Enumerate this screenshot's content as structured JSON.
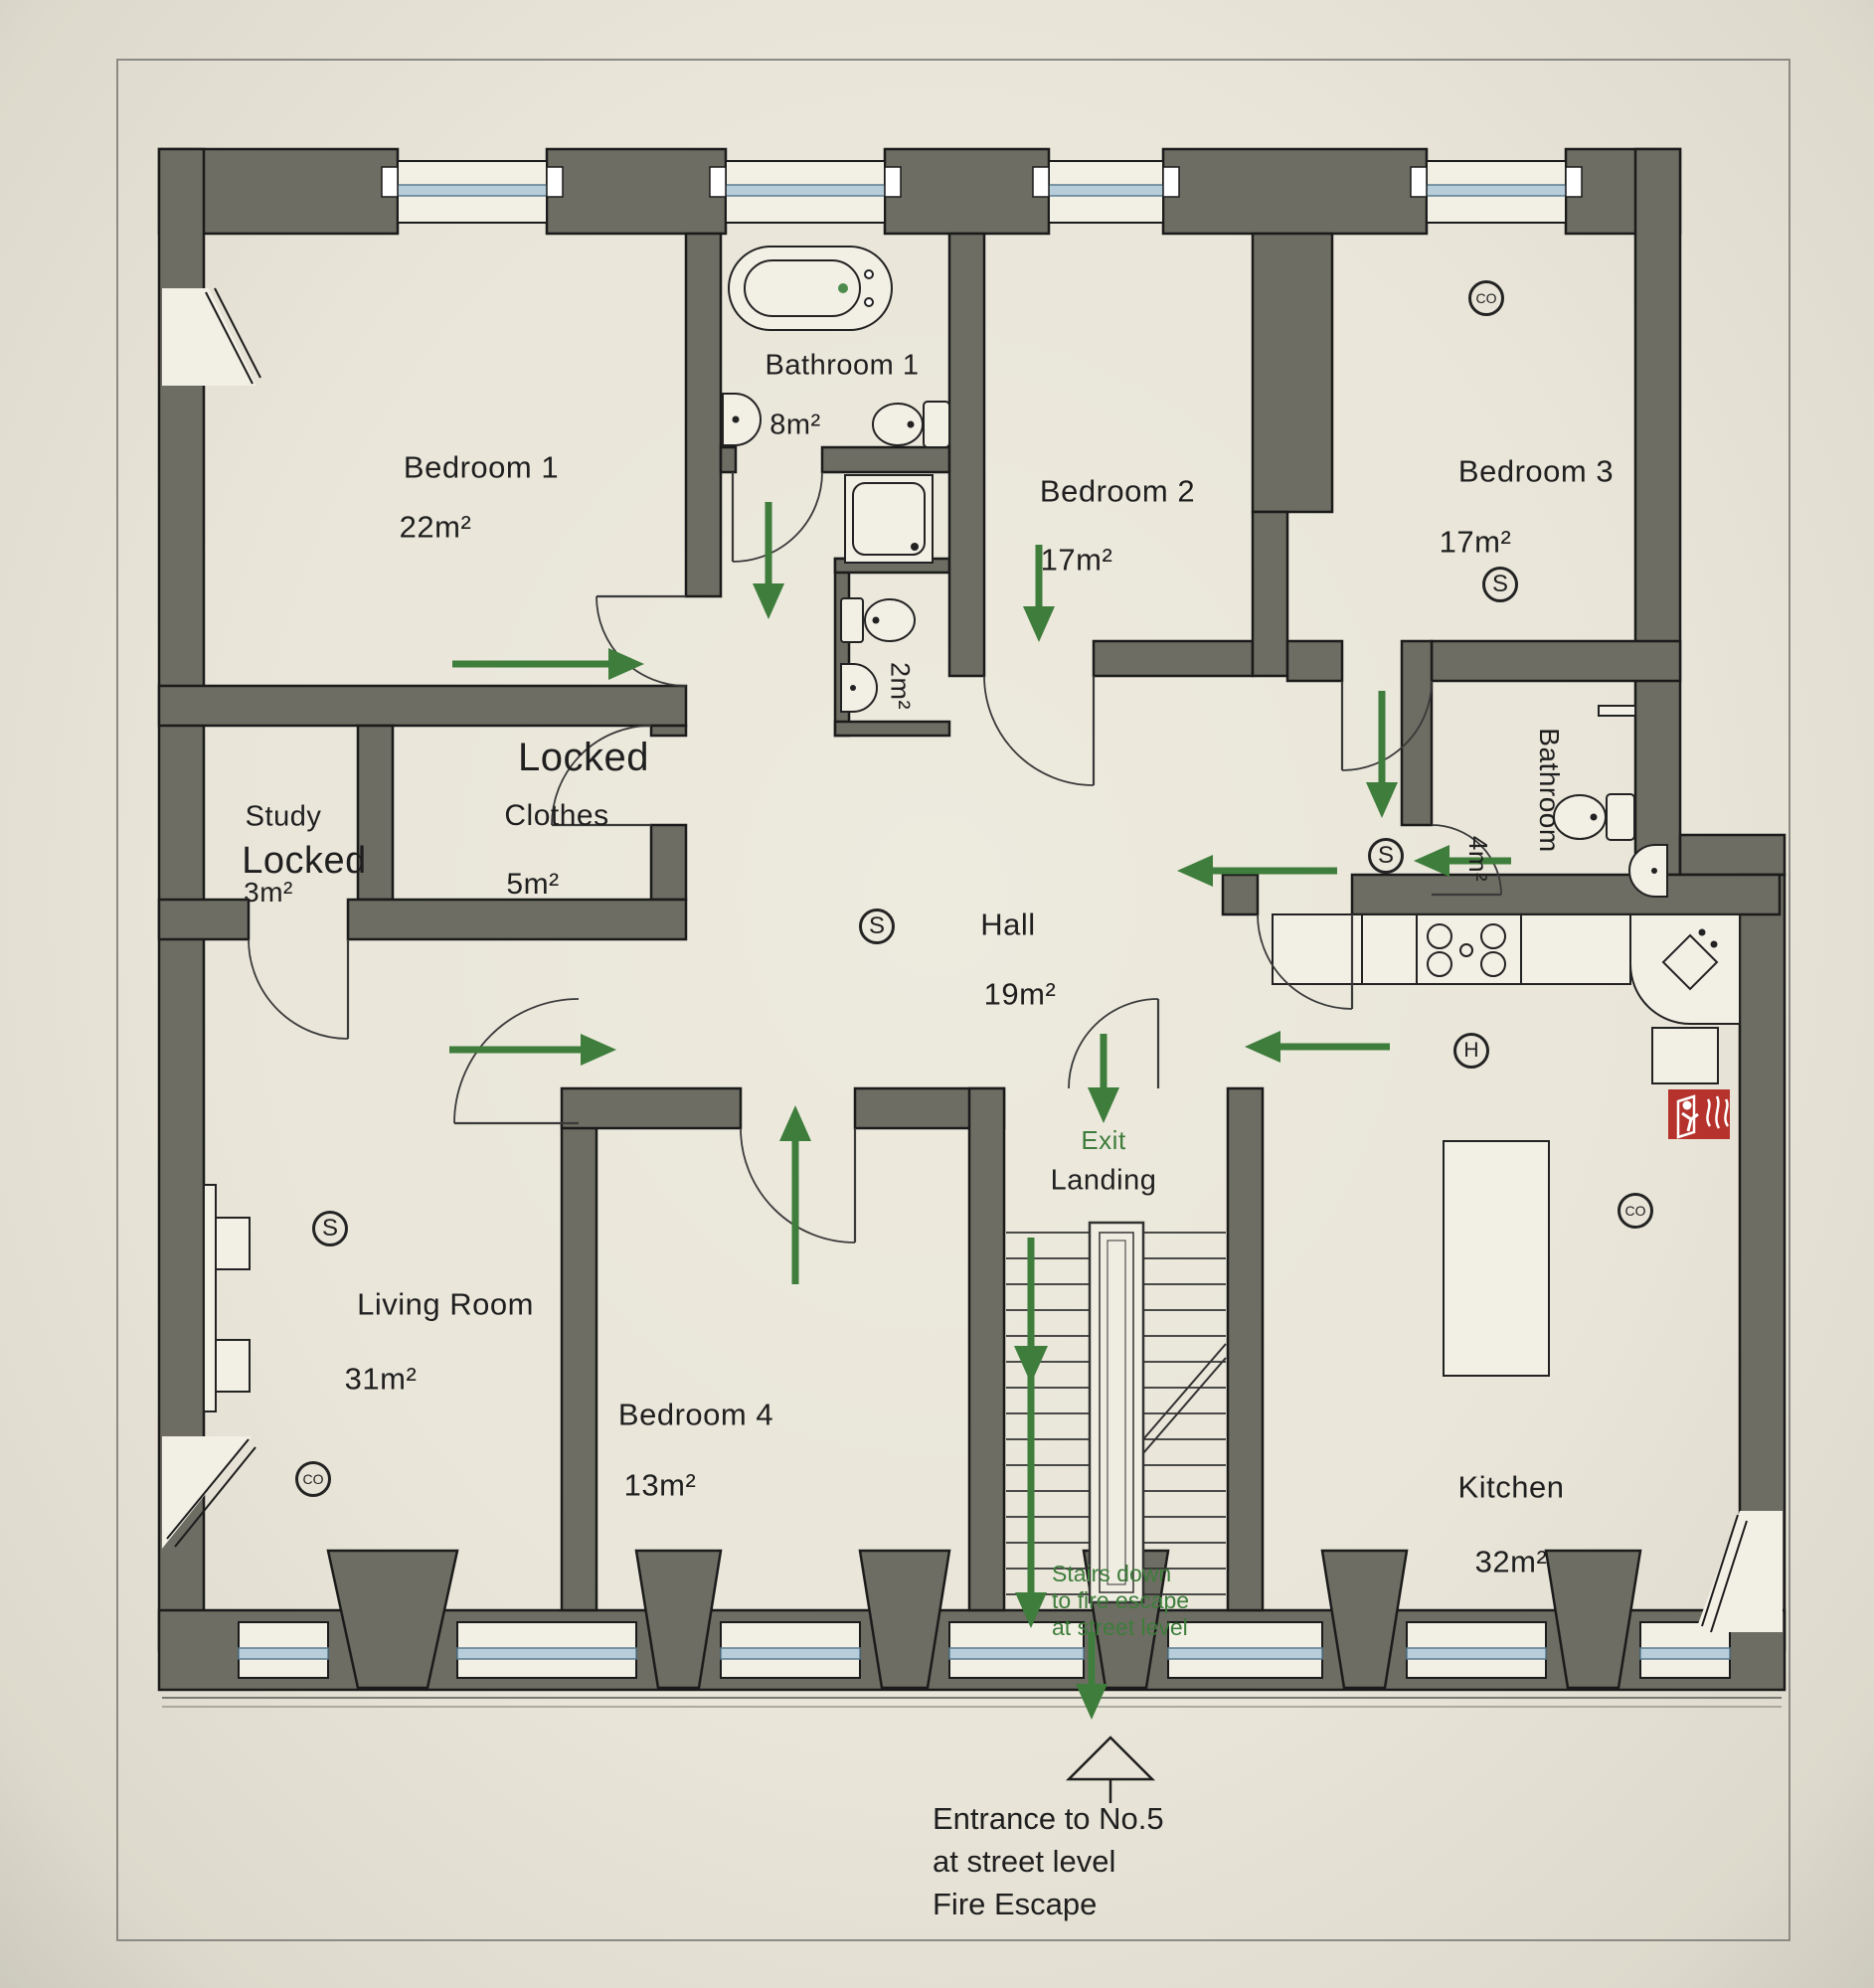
{
  "rooms": {
    "bedroom1": {
      "name": "Bedroom 1",
      "area": "22m²"
    },
    "bathroom1": {
      "name": "Bathroom 1",
      "area": "8m²"
    },
    "wc": {
      "area": "2m²"
    },
    "bedroom2": {
      "name": "Bedroom 2",
      "area": "17m²"
    },
    "bedroom3": {
      "name": "Bedroom 3",
      "area": "17m²"
    },
    "bathroom2": {
      "name": "Bathroom",
      "area": "4m²"
    },
    "hall": {
      "name": "Hall",
      "area": "19m²"
    },
    "study": {
      "name": "Study",
      "area": "3m²",
      "status": "Locked"
    },
    "clothes": {
      "name": "Clothes",
      "area": "5m²",
      "status": "Locked"
    },
    "living_room": {
      "name": "Living Room",
      "area": "31m²"
    },
    "bedroom4": {
      "name": "Bedroom 4",
      "area": "13m²"
    },
    "kitchen": {
      "name": "Kitchen",
      "area": "32m²"
    },
    "landing": {
      "name": "Landing"
    }
  },
  "annotations": {
    "exit": "Exit",
    "stairs_note_line1": "Stairs down",
    "stairs_note_line2": "to fire escape",
    "stairs_note_line3": "at street level",
    "entrance_line1": "Entrance to No.5",
    "entrance_line2": "at street level",
    "entrance_line3": "Fire Escape"
  },
  "icons": {
    "smoke_detector": "S",
    "co_detector": "CO",
    "heat_detector": "H"
  },
  "colors": {
    "wall": "#6d6d63",
    "escape_route": "#3e7d3b",
    "window_glazing": "#b7cdd9",
    "fire_icon": "#b5332c",
    "paper": "#eae6db"
  }
}
